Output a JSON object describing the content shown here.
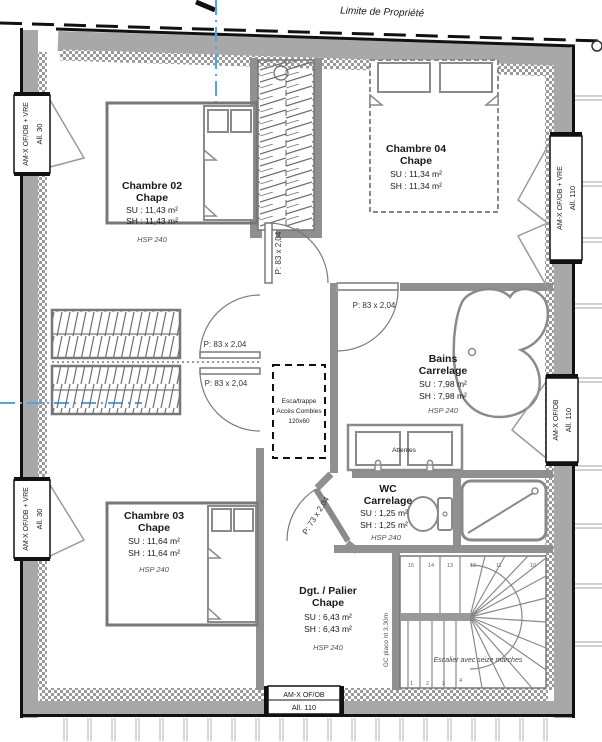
{
  "colors": {
    "wall": "#9a9a9a",
    "accent_blue": "#4da6e8",
    "ink": "#1a1a1a"
  },
  "property_line": {
    "label": "Limite de Propriété"
  },
  "rooms": {
    "chambre02": {
      "name": "Chambre 02",
      "finish": "Chape",
      "su": "SU : 11,43 m²",
      "sh": "SH : 11,43 m²",
      "hsp": "HSP 240"
    },
    "chambre04": {
      "name": "Chambre 04",
      "finish": "Chape",
      "su": "SU : 11,34 m²",
      "sh": "SH : 11,34 m²"
    },
    "chambre03": {
      "name": "Chambre 03",
      "finish": "Chape",
      "su": "SU : 11,64 m²",
      "sh": "SH : 11,64 m²",
      "hsp": "HSP 240"
    },
    "bains": {
      "name": "Bains",
      "finish": "Carrelage",
      "su": "SU : 7,98 m²",
      "sh": "SH : 7,98 m²",
      "hsp": "HSP 240"
    },
    "wc": {
      "name": "WC",
      "finish": "Carrelage",
      "su": "SU : 1,25 m²",
      "sh": "SH : 1,25 m²",
      "hsp": "HSP 240"
    },
    "palier": {
      "name": "Dgt. / Palier",
      "finish": "Chape",
      "su": "SU : 6,43 m²",
      "sh": "SH : 6,43 m²",
      "hsp": "HSP 240"
    }
  },
  "doors": {
    "door_83": "P: 83 x 2,04",
    "door_73": "P: 73 x 2,04"
  },
  "windows": {
    "left_top": {
      "type": "AM-X OF/OB + VRE",
      "allege": "All. 30"
    },
    "left_bottom": {
      "type": "AM-X OF/OB + VRE",
      "allege": "All. 30"
    },
    "right_top": {
      "type": "AM-X OF/OB + VRE",
      "allege": "All. 110"
    },
    "right_middle": {
      "type": "AM-X OF/OB",
      "allege": "All. 110"
    },
    "bottom": {
      "type": "AM-X OF/OB",
      "allege": "All. 110"
    }
  },
  "attic_access": {
    "line1": "Esca/trappe",
    "line2": "Accès Combles",
    "line3": "120x60"
  },
  "bath": {
    "sinks_note": "Attentes"
  },
  "stairs": {
    "caption": "Escalier avec seize marches",
    "guard_note": "GC placo ht 3,30m",
    "top_numbers": [
      "15",
      "14",
      "13",
      "12",
      "11",
      "10"
    ],
    "bottom_numbers": [
      "1",
      "2",
      "3",
      "4"
    ]
  }
}
